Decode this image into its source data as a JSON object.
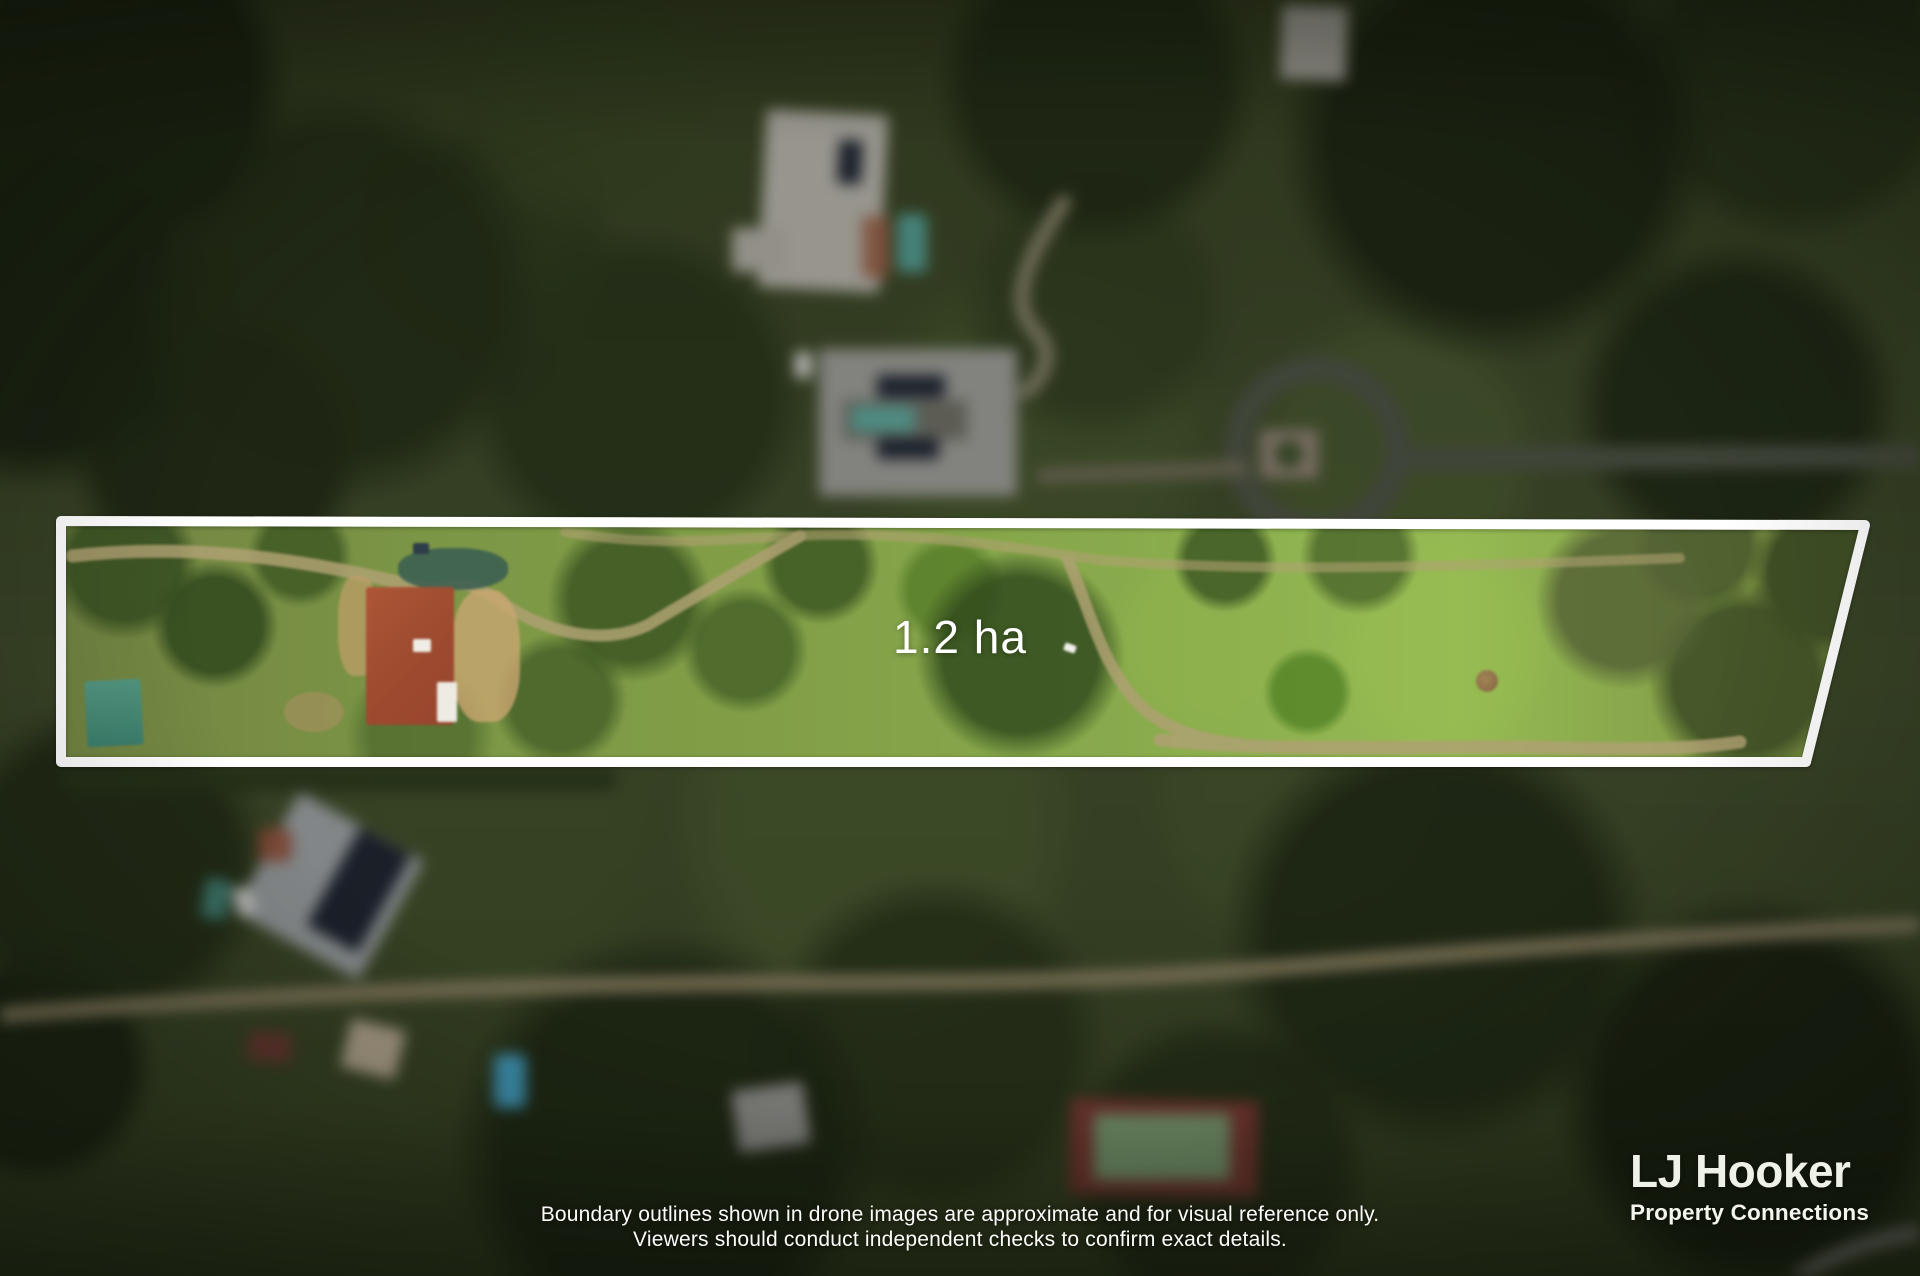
{
  "annotation": {
    "area_label": "1.2 ha",
    "boundary_color": "#ffffff"
  },
  "disclaimer": {
    "line1": "Boundary outlines shown in drone images are approximate and for visual reference only.",
    "line2": "Viewers should conduct independent checks to confirm exact details."
  },
  "brand": {
    "name": "LJ Hooker",
    "tagline": "Property Connections"
  }
}
